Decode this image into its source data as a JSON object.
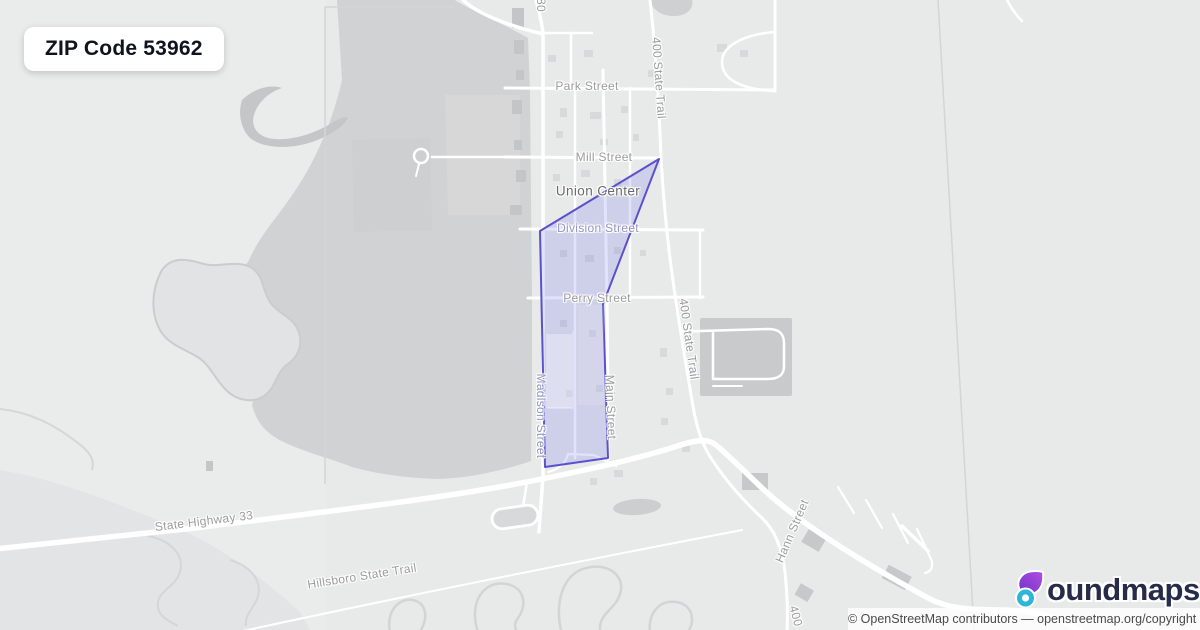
{
  "badge": {
    "zip_label": "ZIP Code 53962"
  },
  "map": {
    "town_label": "Union Center",
    "labels": [
      {
        "text": "80",
        "x": 541,
        "y": 5,
        "deg": 90,
        "cls": ""
      },
      {
        "text": "Park Street",
        "x": 587,
        "y": 86,
        "deg": 0,
        "cls": ""
      },
      {
        "text": "Mill Street",
        "x": 604,
        "y": 157,
        "deg": 0,
        "cls": ""
      },
      {
        "text": "Union Center",
        "x": 598,
        "y": 191,
        "deg": 0,
        "cls": "town"
      },
      {
        "text": "Division Street",
        "x": 598,
        "y": 228,
        "deg": 0,
        "cls": "inzone"
      },
      {
        "text": "Perry Street",
        "x": 597,
        "y": 298,
        "deg": 0,
        "cls": ""
      },
      {
        "text": "400 State Trail",
        "x": 659,
        "y": 78,
        "deg": 86,
        "cls": ""
      },
      {
        "text": "400 State Trail",
        "x": 689,
        "y": 339,
        "deg": 82,
        "cls": ""
      },
      {
        "text": "Madison Street",
        "x": 541,
        "y": 416,
        "deg": 90,
        "cls": "inzone"
      },
      {
        "text": "Main Street",
        "x": 611,
        "y": 407,
        "deg": 88,
        "cls": ""
      },
      {
        "text": "State Highway 33",
        "x": 204,
        "y": 521,
        "deg": -7,
        "cls": ""
      },
      {
        "text": "Hillsboro State Trail",
        "x": 362,
        "y": 576,
        "deg": -9,
        "cls": ""
      },
      {
        "text": "Hann Street",
        "x": 792,
        "y": 531,
        "deg": -67,
        "cls": ""
      },
      {
        "text": "400",
        "x": 796,
        "y": 616,
        "deg": 75,
        "cls": ""
      }
    ]
  },
  "boundary": {
    "name": "ZIP 53962 boundary",
    "stroke": "#5a51cc",
    "fill": "rgba(105,110,235,0.20)"
  },
  "logo": {
    "brand": "boundmaps",
    "brand_rest": "oundmaps",
    "icon": "boundmaps-drop-icon",
    "teal": "#2cb7d9",
    "purple_from": "#6d35c9",
    "purple_to": "#b44ce0",
    "navy": "#262b4a"
  },
  "attribution": {
    "text": "© OpenStreetMap contributors — openstreetmap.org/copyright"
  }
}
